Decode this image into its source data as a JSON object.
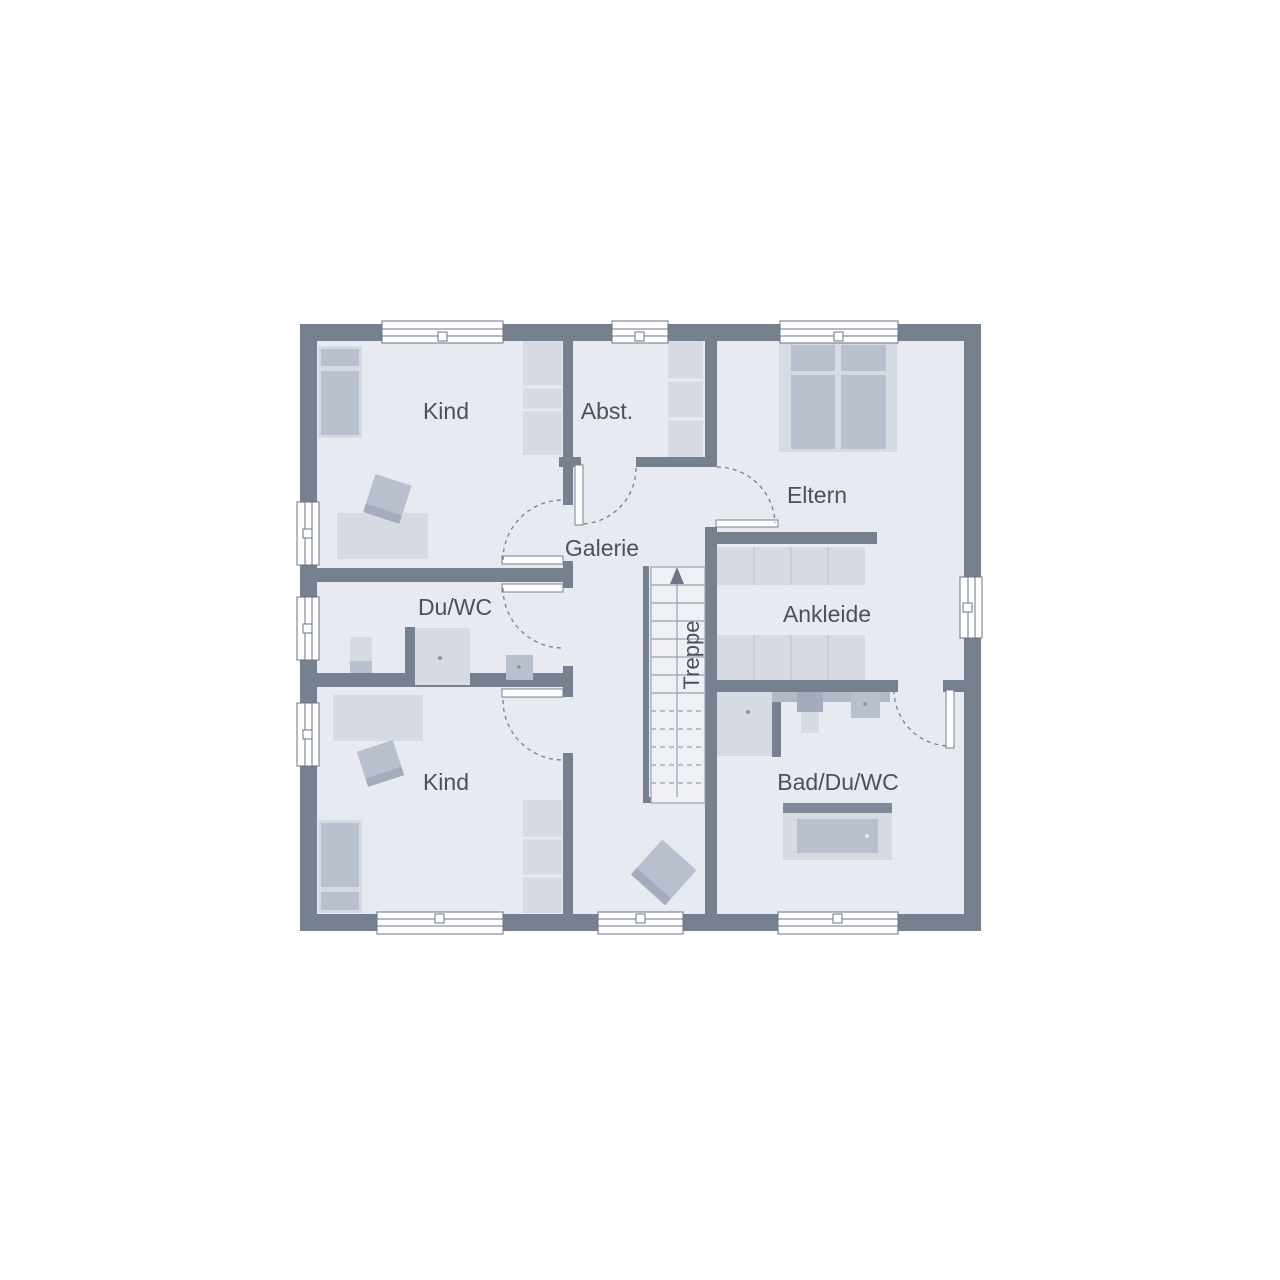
{
  "floorplan": {
    "rooms": {
      "kind_top": "Kind",
      "abst": "Abst.",
      "eltern": "Eltern",
      "galerie": "Galerie",
      "du_wc": "Du/WC",
      "ankleide": "Ankleide",
      "treppe": "Treppe",
      "bad_du_wc": "Bad/Du/WC",
      "kind_bottom": "Kind"
    },
    "colors": {
      "background": "#ffffff",
      "wall": "#76808f",
      "floor": "#e8eaf1",
      "furniture_light": "#d6dae3",
      "furniture_medium": "#b9c0cd",
      "furniture_dark": "#a3abbc",
      "counter": "#b2b9c7",
      "window": "#ffffff",
      "frame_stroke": "#6b7585",
      "stair_line": "#99a0b0",
      "door_dash": "#76808f",
      "text": "#4a5060"
    }
  }
}
